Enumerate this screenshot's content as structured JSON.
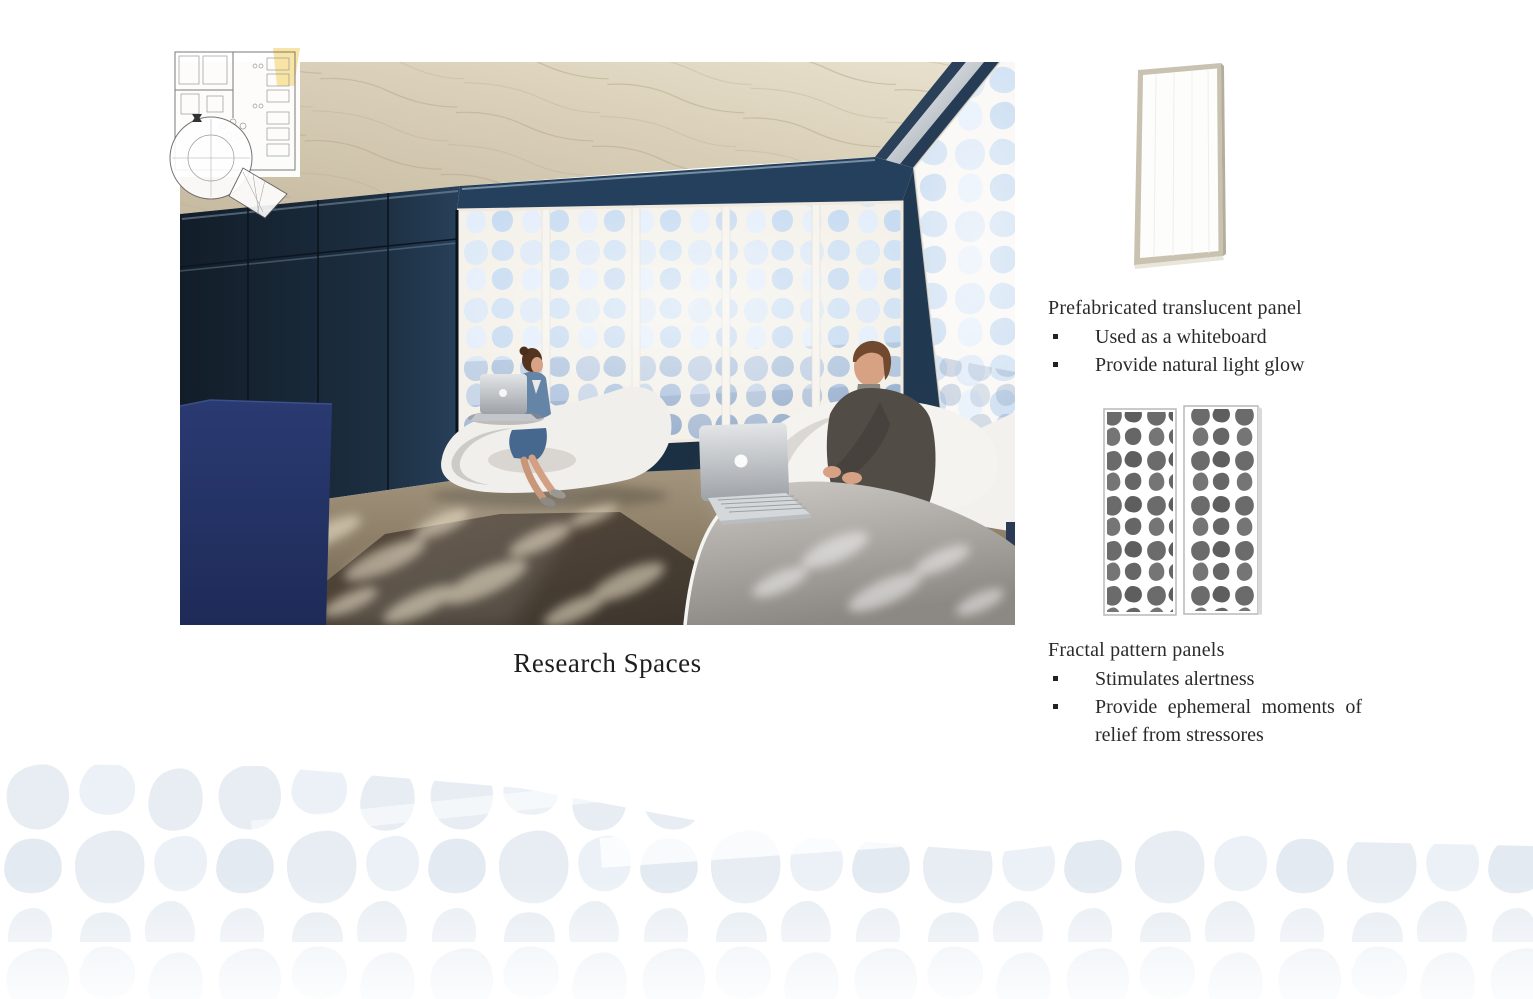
{
  "slide": {
    "caption": "Research Spaces"
  },
  "annotations": {
    "translucent_panel": {
      "title": "Prefabricated translucent panel",
      "bullets": [
        "Used as a whiteboard",
        "Provide natural light glow"
      ]
    },
    "fractal_panels": {
      "title": "Fractal pattern panels",
      "bullets": [
        "Stimulates alertness",
        "Provide ephemeral moments of relief from stressores"
      ]
    }
  },
  "colors": {
    "wall_navy": "#1d2f44",
    "partition_navy": "#243366",
    "ceiling_beige": "#d9cfb8",
    "carpet_tan": "#8f8169",
    "screen_white": "#f7f6f3",
    "sky_blue": "#d9e7f6",
    "pattern_band_blue": "#e8eef4",
    "plan_highlight_yellow": "#f7df94",
    "text_color": "#222222"
  }
}
